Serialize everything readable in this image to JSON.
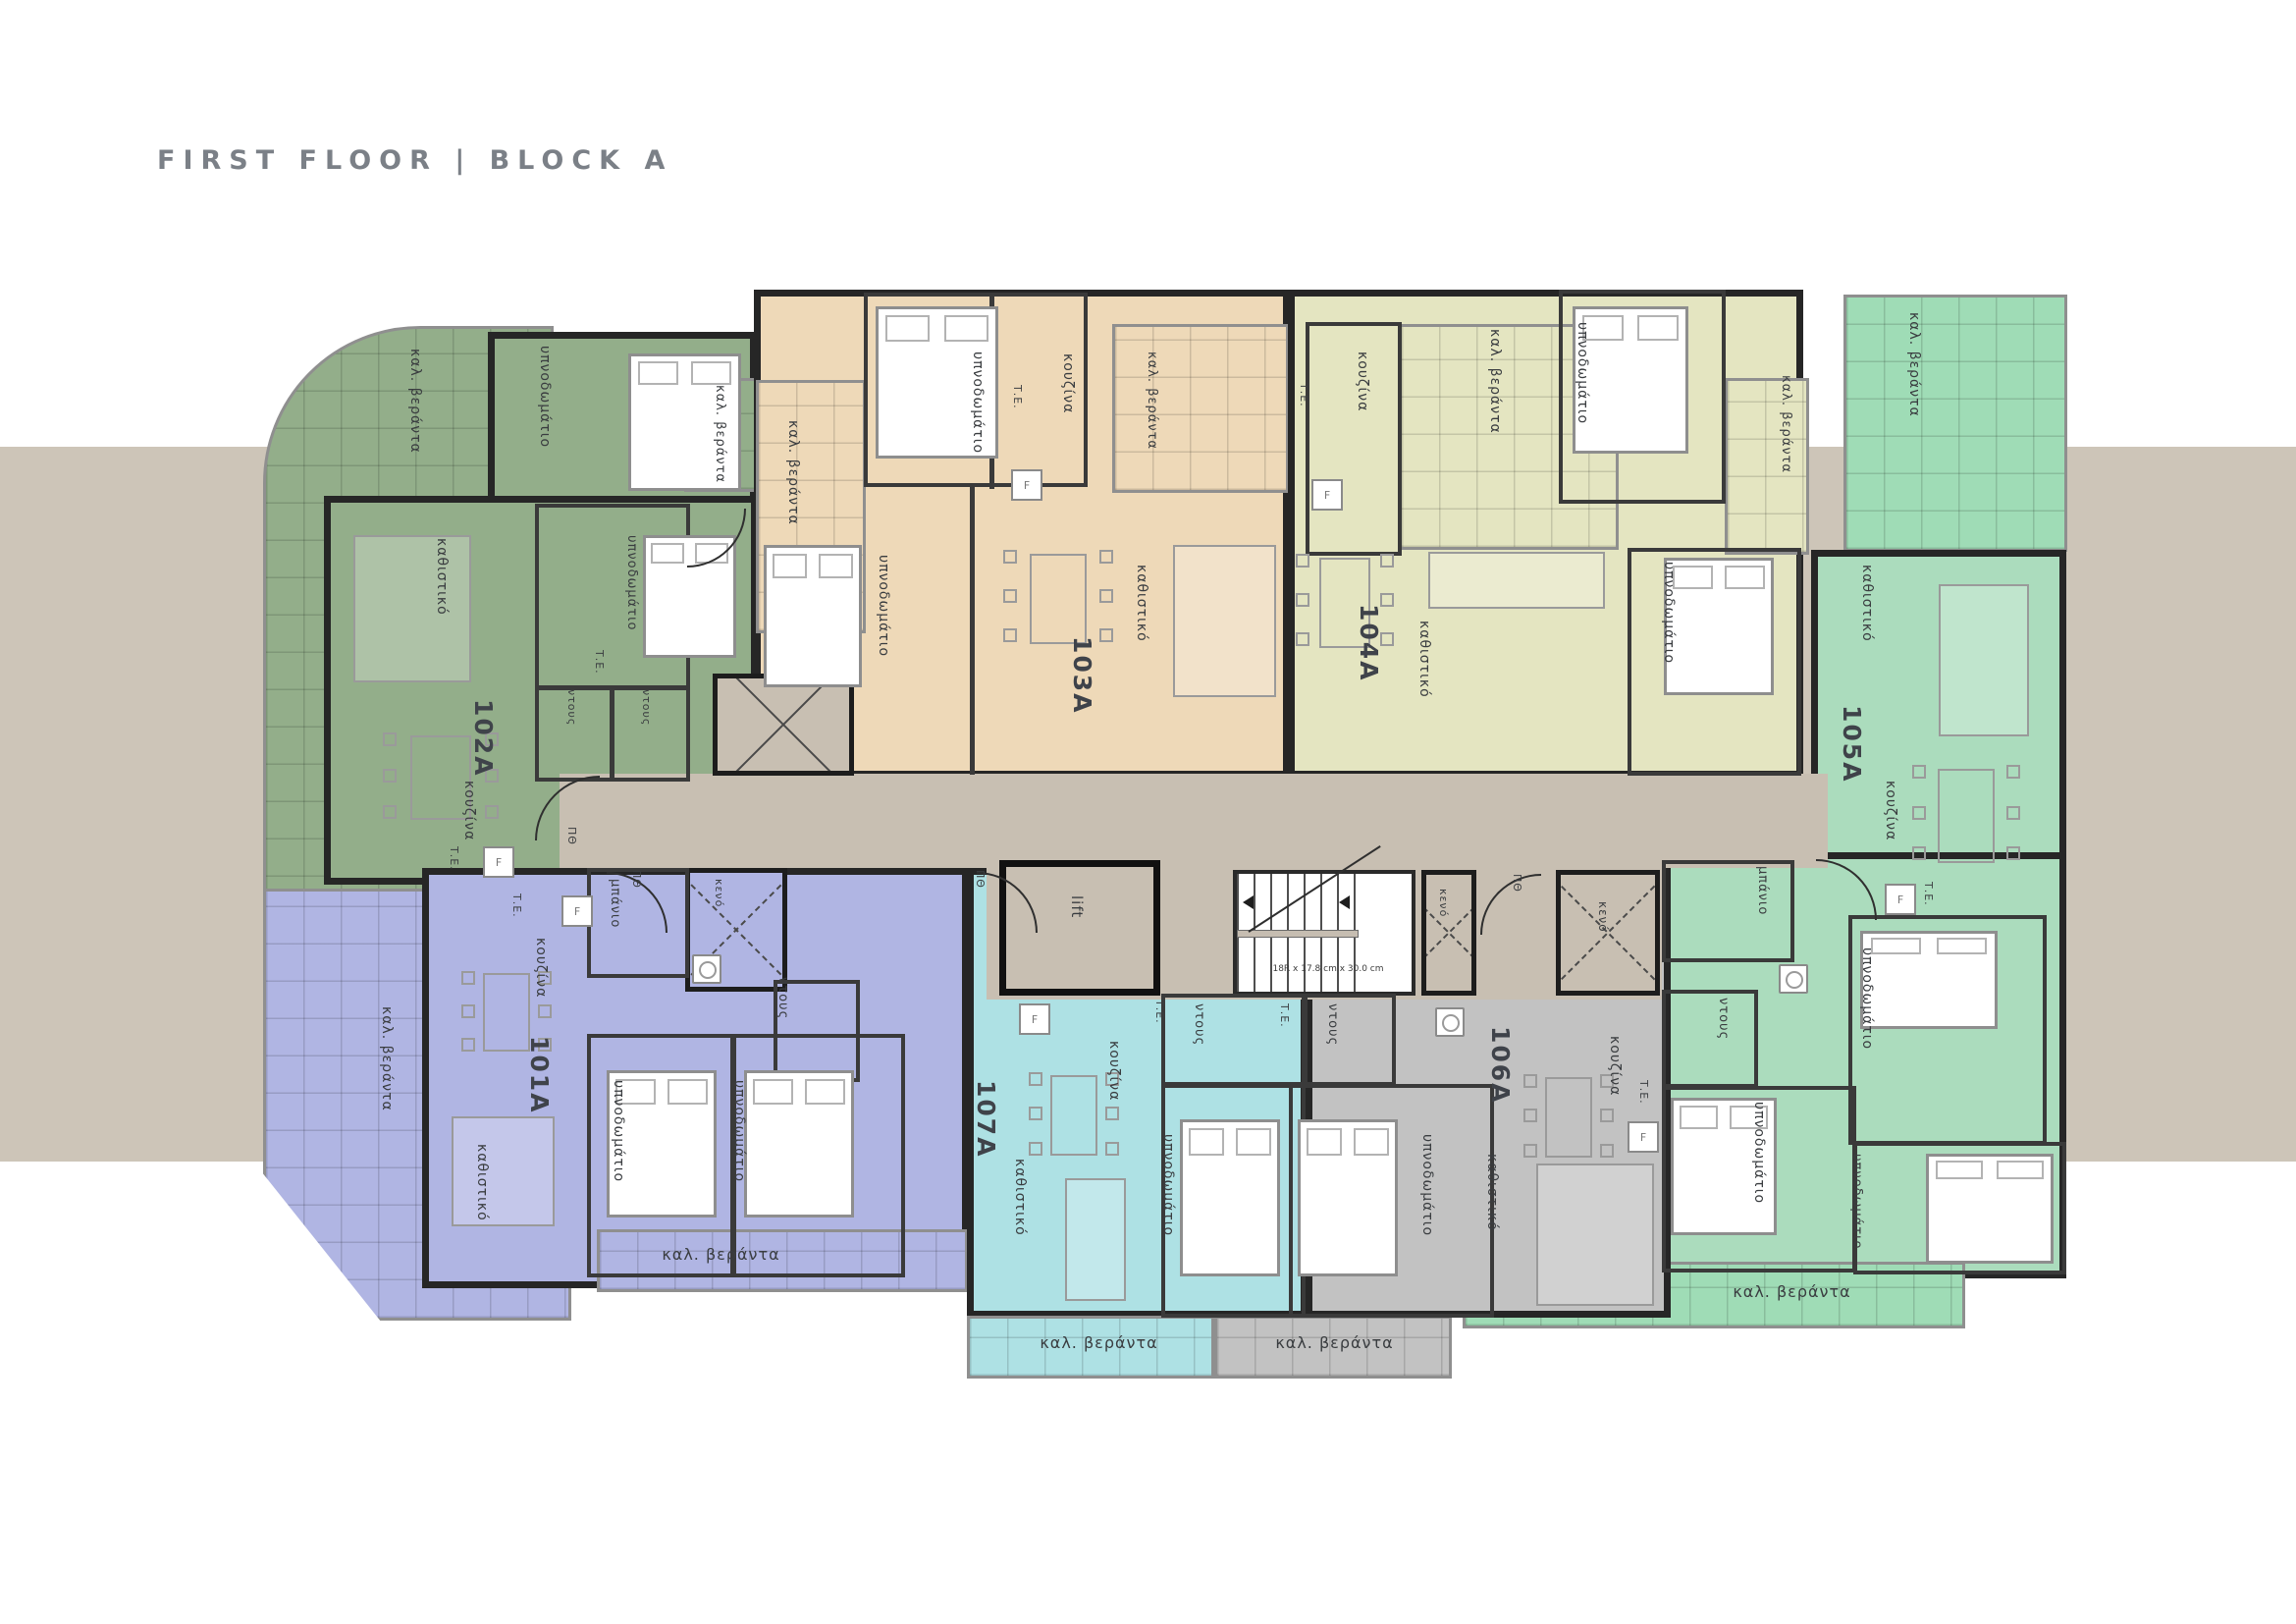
{
  "title": "FIRST FLOOR | BLOCK A",
  "colors": {
    "band": "#cdc5b8",
    "corridor": "#c8bfb2",
    "wall": "#262626",
    "title_text": "#7b8087",
    "a101": "#b0b5e3",
    "a102": "#93ae8a",
    "a103": "#eed9b8",
    "a104": "#e4e5c1",
    "a105": "#abdcbd",
    "a105_veranda": "#9fdcb6",
    "a106": "#c2c2c2",
    "a107": "#aee1e4"
  },
  "labels": {
    "veranda": "καλ. βεράντα",
    "bedroom": "υπνοδωμάτιο",
    "living": "καθιστικό",
    "kitchen": "κουζίνα",
    "bathroom": "μπάνιο",
    "shower": "ντους",
    "void": "κενό",
    "te": "Τ.Ε.",
    "fridge": "F",
    "entry_door": "ΠΘ"
  },
  "core": {
    "lift": "lift",
    "stairs_note": "18R x 17.8 cm x 30.0 cm",
    "void": "κενό"
  },
  "units": {
    "a101": {
      "number": "101A"
    },
    "a102": {
      "number": "102A"
    },
    "a103": {
      "number": "103A"
    },
    "a104": {
      "number": "104A"
    },
    "a105": {
      "number": "105A"
    },
    "a106": {
      "number": "106A"
    },
    "a107": {
      "number": "107A"
    }
  }
}
